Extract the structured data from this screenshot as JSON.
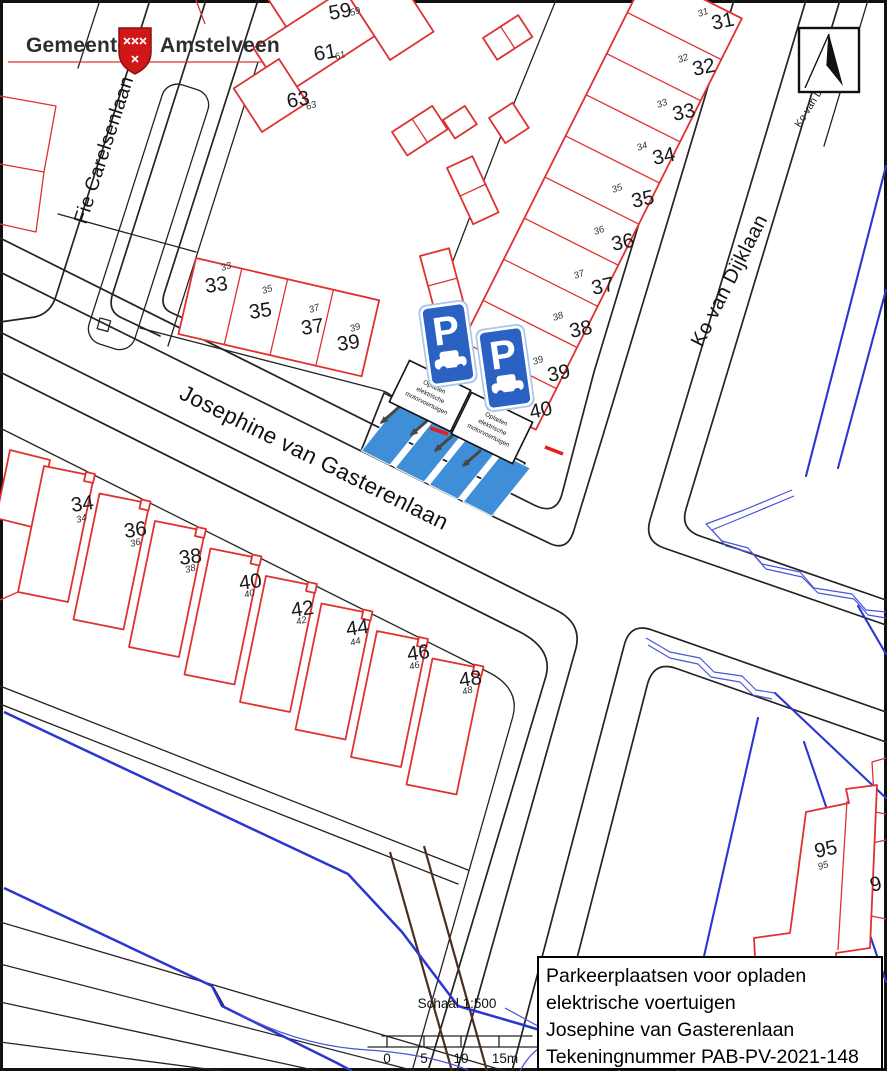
{
  "logo": {
    "municipality": "Gemeente",
    "name": "Amstelveen"
  },
  "streets": {
    "fie": "Fie Carelsenlaan",
    "josephine": "Josephine van Gasterenlaan",
    "ko": "Ko van Dijklaan",
    "ko_small": "Ko van Dijklaan"
  },
  "parking": {
    "sign_letter": "P",
    "note_lines": [
      "Opladen",
      "elektrische",
      "motorvoertuigen"
    ],
    "spot_count": 4
  },
  "house_numbers": {
    "top_block": [
      "59",
      "61",
      "63"
    ],
    "east_row": [
      "31",
      "32",
      "33",
      "34",
      "35",
      "36",
      "37",
      "38",
      "39",
      "40"
    ],
    "mid_row": [
      "33",
      "35",
      "37",
      "39"
    ],
    "south_row": [
      "34",
      "36",
      "38",
      "40",
      "42",
      "44",
      "46",
      "48"
    ],
    "southeast": [
      "95"
    ],
    "edge_partial": "9"
  },
  "scale_bar": {
    "label": "Schaal 1:500",
    "ticks": [
      "0",
      "5",
      "10",
      "15m"
    ]
  },
  "title_block": {
    "lines": [
      "Parkeerplaatsen voor opladen",
      "elektrische voertuigen",
      "Josephine van Gasterenlaan",
      "Tekeningnummer PAB-PV-2021-148"
    ]
  },
  "colors": {
    "building_outline": "#e03131",
    "water": "#2b36cf",
    "parking_spot": "#3f8fd8",
    "sign_blue": "#2a62c4",
    "path_brown": "#4a2e20",
    "street_line": "#232323"
  }
}
